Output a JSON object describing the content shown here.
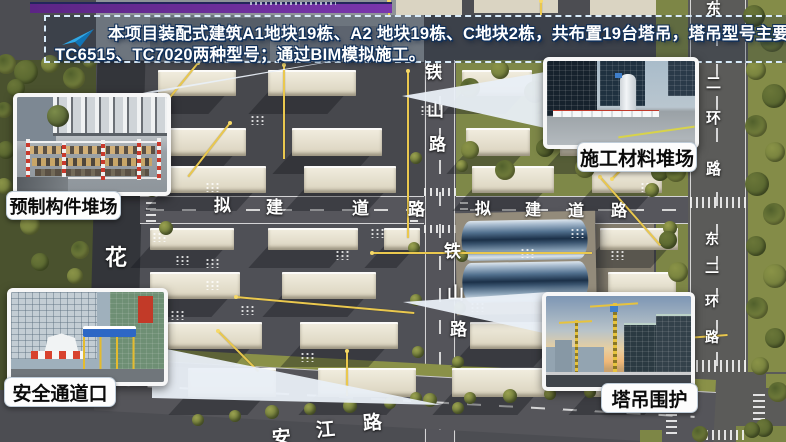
{
  "banner": {
    "icon": "paper-plane-icon",
    "line1": "本项目装配式建筑A1地块19栋、A2 地块19栋、C地块2栋，共布置19台塔吊，塔吊型号主要使用",
    "line2": "TC6515、TC7020两种型号；通过BIM模拟施工。",
    "border_color": "#d9ecfb",
    "icon_color": "#2fa8e8",
    "text_color": "#ffffff"
  },
  "callouts": [
    {
      "id": "precast-yard",
      "label": "预制构件堆场"
    },
    {
      "id": "material-yard",
      "label": "施工材料堆场"
    },
    {
      "id": "safety-gate",
      "label": "安全通道口"
    },
    {
      "id": "crane-enclosure",
      "label": "塔吊围护"
    }
  ],
  "map": {
    "road_labels": [
      {
        "name": "tieshan-road",
        "text": "铁山路",
        "orientation": "vertical",
        "occurrences": 2
      },
      {
        "name": "east-second-ring-road",
        "text": "东二环路",
        "orientation": "vertical",
        "occurrences": 2
      },
      {
        "name": "proposed-road",
        "text": "拟建道路",
        "orientation": "horizontal",
        "occurrences": 2
      },
      {
        "name": "anjiang-road",
        "text": "安江路",
        "orientation": "diagonal",
        "occurrences": 1
      },
      {
        "name": "hua-road",
        "text": "花",
        "orientation": "vertical",
        "occurrences": 1
      }
    ],
    "crane_line_color": "#eac84e",
    "label_color": "#ffffff"
  },
  "decor": {
    "top_bar_color": "#6b2f9e",
    "callout_pill_bg": "#fdfdfd",
    "callout_pill_text": "#0b0b0b"
  }
}
